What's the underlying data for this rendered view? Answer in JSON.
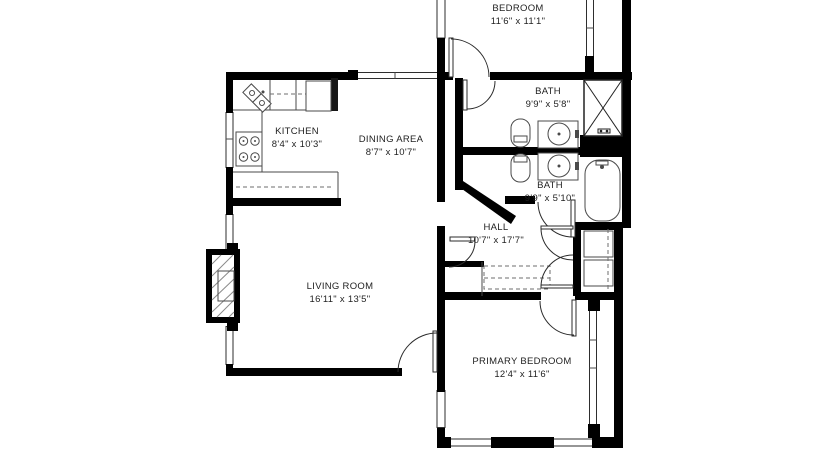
{
  "title": "Apartment floor plan",
  "colors": {
    "wall": "#000000",
    "fixture_line": "#4a4a4a",
    "text": "#1f1f1f",
    "background": "#ffffff"
  },
  "rooms": [
    {
      "id": "bedroom",
      "name": "BEDROOM",
      "dims": "11'6\" x 11'1\""
    },
    {
      "id": "kitchen",
      "name": "KITCHEN",
      "dims": "8'4\" x 10'3\""
    },
    {
      "id": "dining-area",
      "name": "DINING AREA",
      "dims": "8'7\" x 10'7\""
    },
    {
      "id": "bath-upper",
      "name": "BATH",
      "dims": "9'9\" x 5'8\""
    },
    {
      "id": "bath-lower",
      "name": "BATH",
      "dims": "9'9\" x 5'10\""
    },
    {
      "id": "hall",
      "name": "HALL",
      "dims": "10'7\" x 17'7\""
    },
    {
      "id": "living-room",
      "name": "LIVING ROOM",
      "dims": "16'11\" x 13'5\""
    },
    {
      "id": "primary-bedroom",
      "name": "PRIMARY BEDROOM",
      "dims": "12'4\" x 11'6\""
    }
  ],
  "fixtures": [
    "kitchen-corner-sink",
    "range",
    "refrigerator",
    "counters",
    "toilet",
    "toilet",
    "vanity-sink",
    "vanity-sink",
    "shower",
    "bathtub",
    "fireplace",
    "hall-closet",
    "shelf-closet",
    "entry-door"
  ]
}
